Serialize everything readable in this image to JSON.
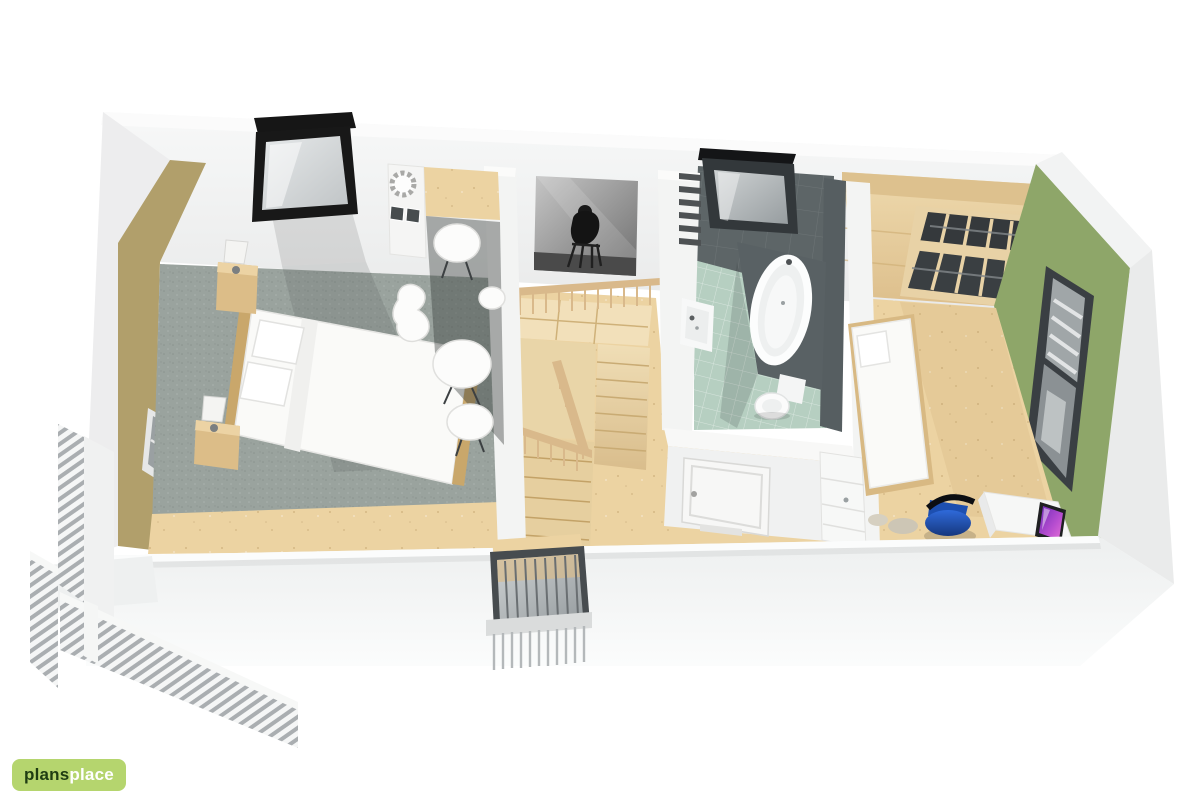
{
  "app": {
    "background": "#ffffff",
    "view": "3d-floor-plan-render"
  },
  "branding": {
    "logo": {
      "text_primary": "plans",
      "text_secondary": "place",
      "bg_color": "#b5d56e",
      "primary_color": "#1f3d12",
      "secondary_color": "#ffffff"
    }
  },
  "scene": {
    "description": "Isometric 3D cutaway floor plan of an attic storey: master bedroom with vanity corner, stair landing with artwork, bathroom, second bedroom with wardrobe and desk, balcony outside left end",
    "colors": {
      "outer_wall": "#f1f2f2",
      "inner_wall": "#f4f5f4",
      "accent_wall_tan": "#b19f6b",
      "accent_wall_green": "#8ea669",
      "wood_floor": "#ecd3a2",
      "wood_furniture": "#d9ba84",
      "stair_wood": "#eeddb4",
      "railing_wood": "#d9b98b",
      "carpet": "#9aa39e",
      "bath_floor_tile": "#b6cfc1",
      "bath_wall_tile": "#5d6567",
      "window_frame_dark": "#3f4448",
      "skylight_frame": "#161616",
      "bedding_white": "#fafaf8",
      "desk_chair_blue": "#2a63d4",
      "imac_screen_purple": "#9b3fd1"
    },
    "rooms": [
      {
        "id": "bedroom-left",
        "label": "Master bedroom",
        "items": [
          "double bed",
          "two nightstands with lamps",
          "tall wall picture",
          "roof window leaning on wall",
          "vanity cabinet with mirror ornament",
          "wood counter",
          "white stools",
          "designer chair",
          "grey carpet",
          "wood floor strip",
          "gable window"
        ]
      },
      {
        "id": "stair-landing",
        "label": "Stair landing",
        "items": [
          "U-shaped wooden staircase",
          "wooden balustrades",
          "black-and-white wall artwork",
          "front dormer window with railing"
        ]
      },
      {
        "id": "bathroom",
        "label": "Bathroom",
        "items": [
          "bathtub in tiled surround",
          "wash basin",
          "toilet",
          "roof window",
          "wall radiator",
          "white panel door",
          "mint tile floor"
        ]
      },
      {
        "id": "bedroom-right",
        "label": "Bedroom",
        "items": [
          "single bed",
          "open wardrobe with dark shelves",
          "white desk",
          "computer monitor",
          "blue swivel chair",
          "hall cabinet",
          "gable window with shutter slats"
        ]
      }
    ],
    "exterior": [
      "balcony with slatted railing at left end",
      "white outer walls"
    ]
  }
}
